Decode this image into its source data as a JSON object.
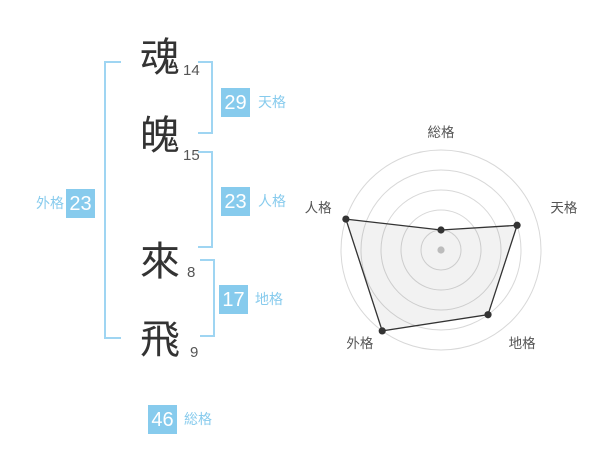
{
  "colors": {
    "accent_blue": "#87cbed",
    "bracket_blue": "#9fd5f2",
    "badge_text": "#ffffff",
    "kanji": "#333333",
    "stroke_count": "#555555",
    "ring": "#d8d8d8",
    "polygon_stroke": "#333333",
    "polygon_fill": "rgba(0,0,0,0.05)",
    "center_dot": "#bcbcbc",
    "radar_label": "#555555"
  },
  "name_panel": {
    "chars": [
      {
        "char": "魂",
        "strokes": "14"
      },
      {
        "char": "魄",
        "strokes": "15"
      },
      {
        "char": "來",
        "strokes": "8"
      },
      {
        "char": "飛",
        "strokes": "9"
      }
    ],
    "scores": {
      "tenkaku": {
        "value": "29",
        "label": "天格"
      },
      "jinkaku": {
        "value": "23",
        "label": "人格"
      },
      "chikaku": {
        "value": "17",
        "label": "地格"
      },
      "gaikaku": {
        "value": "23",
        "label": "外格"
      },
      "soukaku": {
        "value": "46",
        "label": "総格"
      }
    }
  },
  "chart_data": {
    "type": "radar",
    "title": "",
    "axes": [
      "総格",
      "天格",
      "地格",
      "外格",
      "人格"
    ],
    "values": [
      1,
      4,
      4,
      5,
      5
    ],
    "max": 5,
    "rings": 5,
    "grid": "concentric-circles",
    "legend": "none",
    "center_marker": true
  }
}
